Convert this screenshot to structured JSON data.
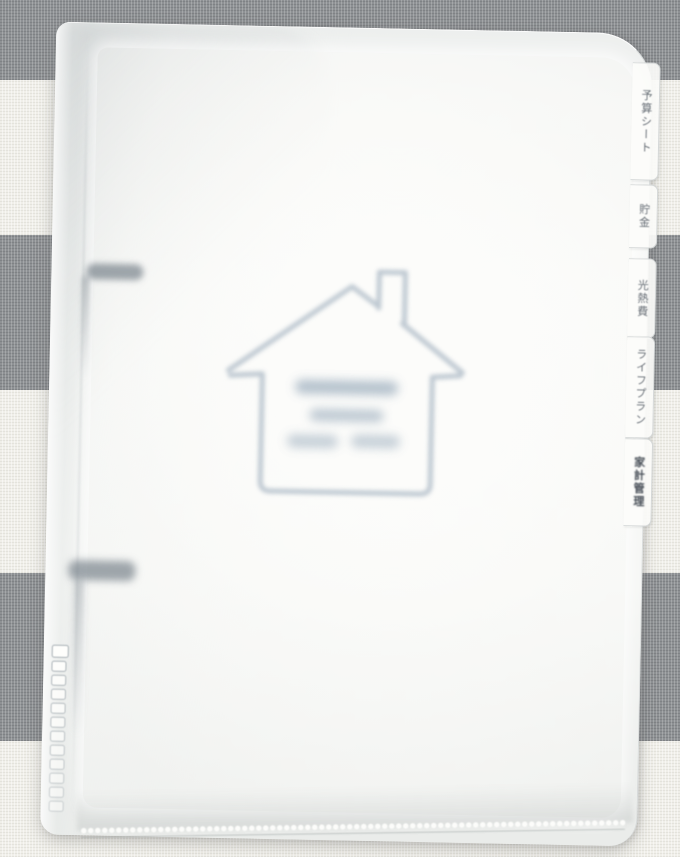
{
  "scene_type": "photo of household budget binder with frosted cover on striped fabric",
  "colors": {
    "fabric_gray": "#8e9194",
    "fabric_white": "#f0efe9",
    "page_white": "#fcfcfa",
    "house_line": "#b3bfca",
    "blur_text": "#8fa3b5",
    "tab_text": "#646b73",
    "tab_text_dark": "#454c55"
  },
  "binder": {
    "tabs": [
      {
        "label": "予算シート"
      },
      {
        "label": "貯金"
      },
      {
        "label": "光熱費"
      },
      {
        "label": "ライフプラン"
      },
      {
        "label": "家計管理"
      }
    ],
    "ring_count": 2,
    "zip_teeth": {
      "count": 12
    },
    "house_icon": {
      "blurred_text_line_count": 3
    }
  }
}
